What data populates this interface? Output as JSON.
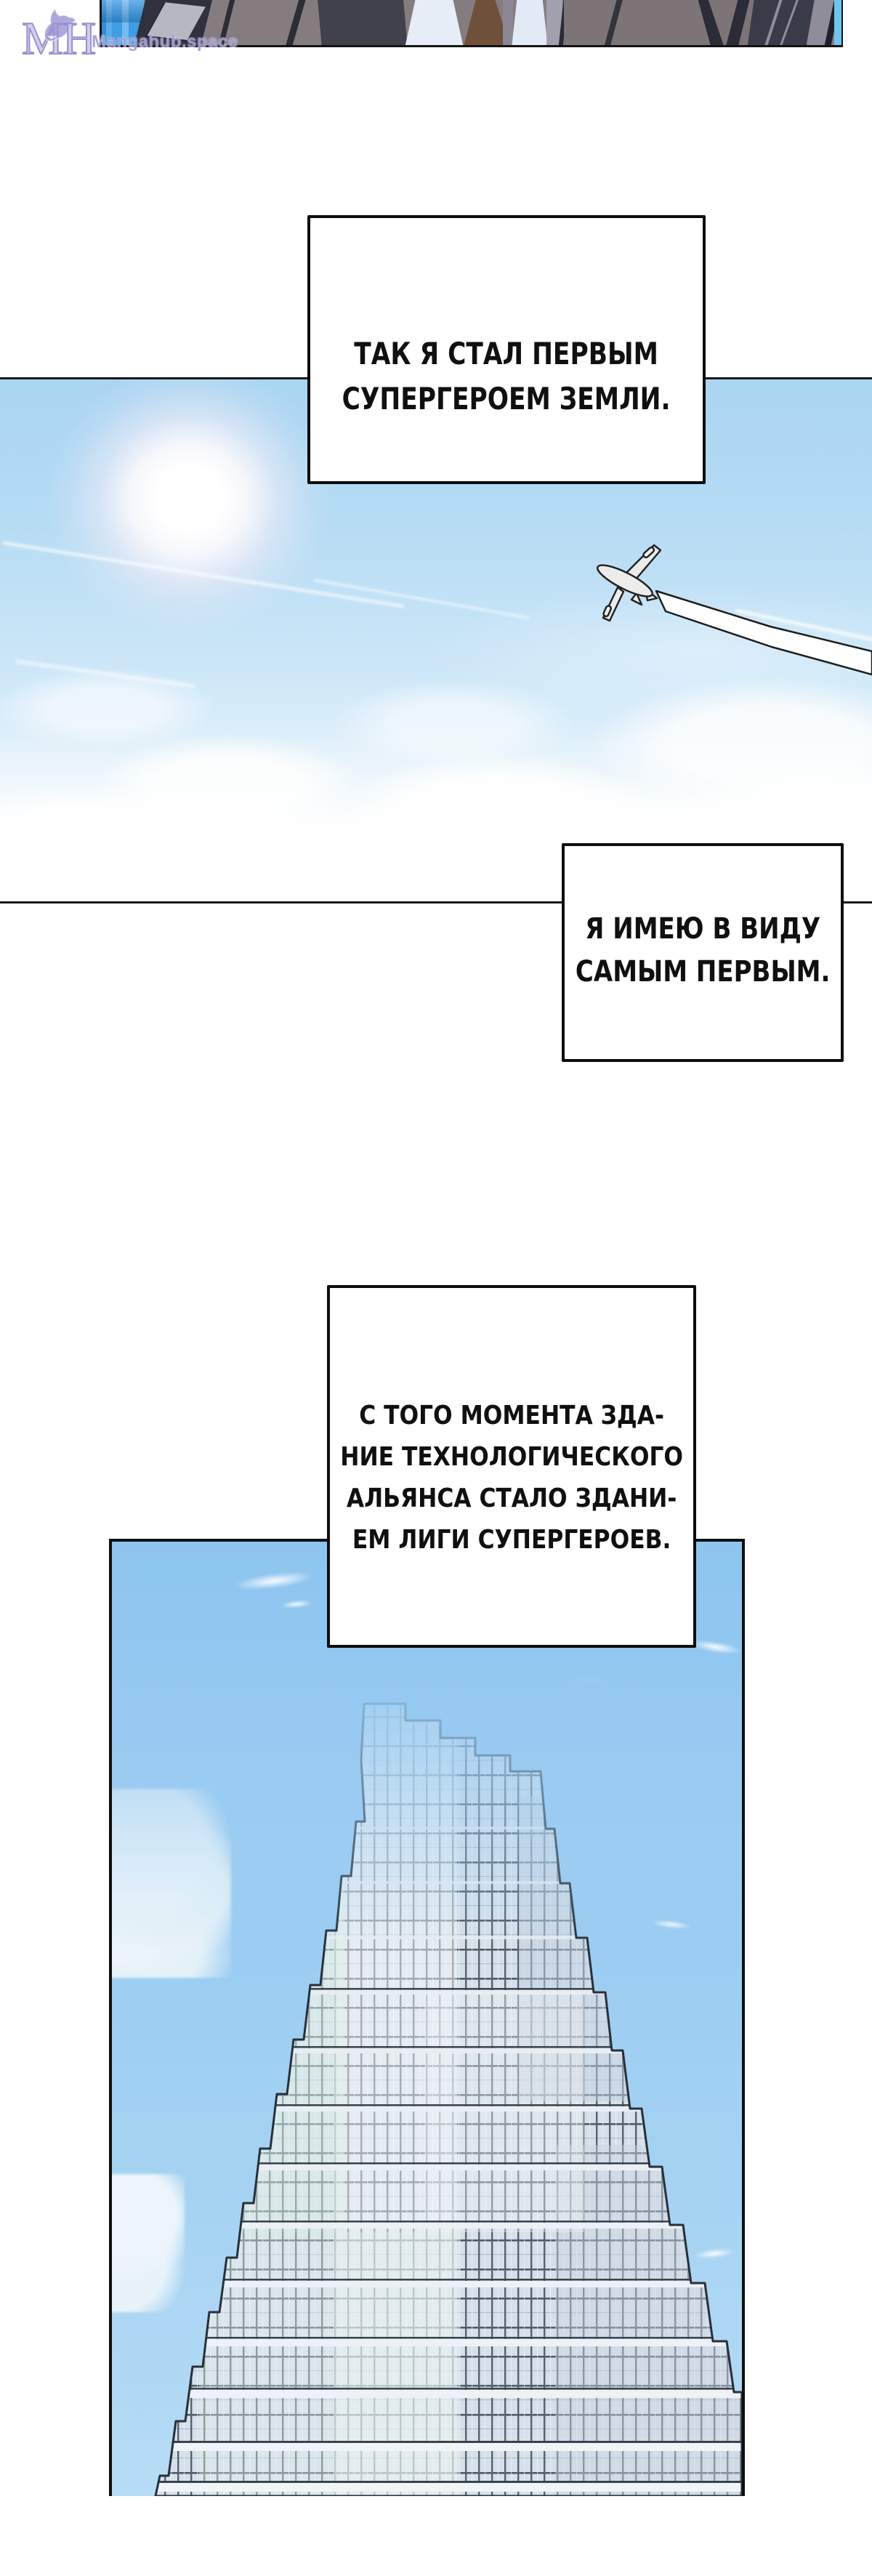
{
  "watermark": {
    "monogram_left": "M",
    "monogram_right": "H",
    "site": "Mangahub.space"
  },
  "narration_boxes": [
    {
      "lines": [
        "ТАК Я СТАЛ ПЕРВЫМ",
        "СУПЕРГЕРОЕМ ЗЕМЛИ."
      ]
    },
    {
      "lines": [
        "Я ИМЕЮ В ВИДУ",
        "САМЫМ ПЕРВЫМ."
      ]
    },
    {
      "lines": [
        "С ТОГО МОМЕНТА ЗДА-",
        "НИЕ ТЕХНОЛОГИЧЕСКОГО",
        "АЛЬЯНСА СТАЛО ЗДАНИ-",
        "ЕМ ЛИГИ СУПЕРГЕРОЕВ."
      ]
    }
  ],
  "icons": {
    "logo": "fox-monogram-icon",
    "airplane": "airplane-icon",
    "sun": "sun-glow",
    "clouds": "cloud-shapes",
    "building": "skyscraper-art"
  },
  "colors": {
    "sky_panel_top": "#a9d5f2",
    "sky_panel_deep": "#8ec5ef",
    "panel_border": "#0f0f0f",
    "watermark_purple": "#9893d4",
    "building_glass": "#d5e0ea",
    "building_mullion": "#57626d",
    "contrail": "#ffffff",
    "tie_brown": "#6e5138",
    "glass_wall_blue": "#3f9de4"
  }
}
